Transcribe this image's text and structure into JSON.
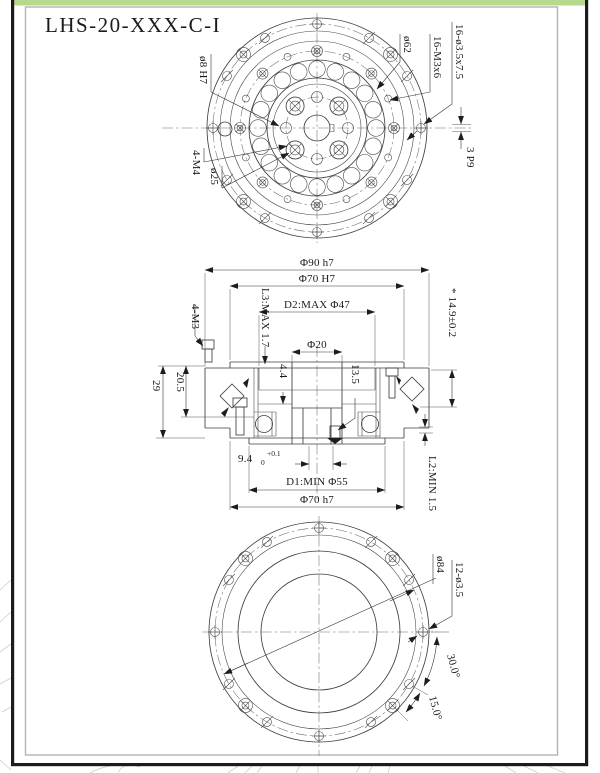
{
  "drawing": {
    "title": "LHS-20-XXX-C-I",
    "colors": {
      "top_bar_green": "#b5d98d",
      "frame_black": "#1c1c1c",
      "inner_frame_gray": "#b3b3b3",
      "line_color": "#3f3f3f"
    },
    "top_view": {
      "dowel_hole": "ø8 H7",
      "tapped_holes_m4": "4-M4",
      "bolt_circle_25": "ø25",
      "bolt_circle_62": "ø62",
      "tapped_holes_m3": "16-M3x6",
      "counterbore_holes": "16-ø3.5x7.5",
      "keyway": "3 P9"
    },
    "section_view": {
      "outer_dia": "Φ90 h7",
      "pilot_bore": "Φ70 H7",
      "d2_max": "D2:MAX Φ47",
      "center_bore": "Φ20",
      "l3_max": "L3:MAX 1.7",
      "tapped_holes_m3": "4-M3",
      "height_tol": "* 14.9±0.2",
      "h_205": "20.5",
      "h_29": "29",
      "h_44": "4.4",
      "h_135": "13.5",
      "off_94": "9.4",
      "off_94_sub": "0",
      "off_94_sup": "+0.1",
      "d1_min": "D1:MIN Φ55",
      "spigot_dia": "Φ70 h7",
      "l2_min": "L2:MIN 1.5"
    },
    "bottom_view": {
      "bolt_circle_84": "ø84",
      "through_holes": "12-ø3.5",
      "angle_30": "30.0°",
      "angle_15": "15.0°"
    }
  }
}
